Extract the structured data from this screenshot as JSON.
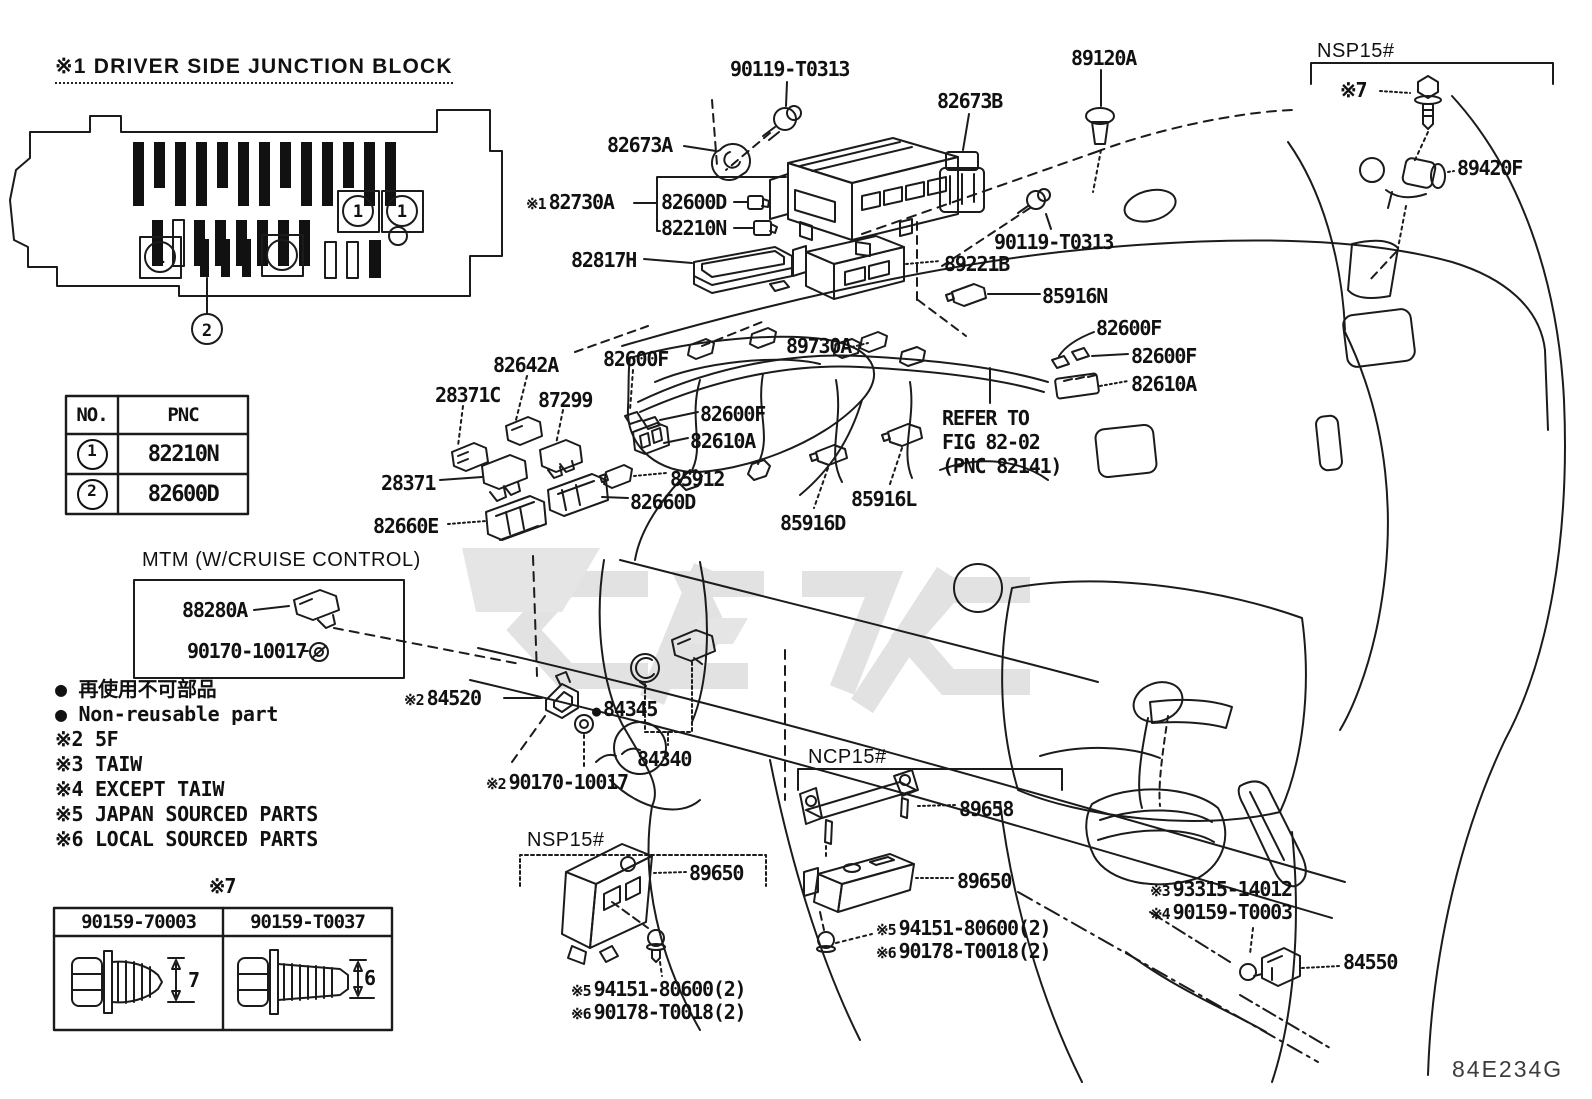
{
  "header": {
    "title": "※1 DRIVER SIDE JUNCTION BLOCK"
  },
  "figure_code": "84E234G",
  "callouts": {
    "fuse_no": "1",
    "junction_block_no": "2"
  },
  "pnc_table": {
    "col_no": "NO.",
    "col_pnc": "PNC",
    "rows": [
      {
        "no": "1",
        "pnc": "82210N"
      },
      {
        "no": "2",
        "pnc": "82600D"
      }
    ]
  },
  "bolt_table": {
    "caption": "※7",
    "columns": [
      {
        "part": "90159-70003",
        "dim": "7"
      },
      {
        "part": "90159-T0037",
        "dim": "6"
      }
    ]
  },
  "legend": {
    "items": [
      "● 再使用不可部品",
      "● Non-reusable part",
      "※2 5F",
      "※3 TAIW",
      "※4 EXCEPT TAIW",
      "※5 JAPAN SOURCED PARTS",
      "※6 LOCAL SOURCED PARTS"
    ]
  },
  "part_labels": [
    {
      "text": "90119-T0313",
      "x": 730,
      "y": 57
    },
    {
      "text": "89120A",
      "x": 1071,
      "y": 46
    },
    {
      "text": "NSP15#",
      "x": 1317,
      "y": 40,
      "style": "plain"
    },
    {
      "text": "※7",
      "x": 1340,
      "y": 78
    },
    {
      "text": "82673B",
      "x": 937,
      "y": 89
    },
    {
      "text": "82673A",
      "x": 607,
      "y": 133
    },
    {
      "text": "89420F",
      "x": 1457,
      "y": 156
    },
    {
      "prefix": "※1",
      "text": "82730A",
      "x": 526,
      "y": 190
    },
    {
      "text": "82600D",
      "x": 661,
      "y": 190
    },
    {
      "text": "82210N",
      "x": 661,
      "y": 216
    },
    {
      "text": "90119-T0313",
      "x": 994,
      "y": 230
    },
    {
      "text": "82817H",
      "x": 571,
      "y": 248
    },
    {
      "text": "89221B",
      "x": 944,
      "y": 252
    },
    {
      "text": "85916N",
      "x": 1042,
      "y": 284
    },
    {
      "text": "82600F",
      "x": 1096,
      "y": 316
    },
    {
      "text": "89730A",
      "x": 786,
      "y": 334
    },
    {
      "text": "82600F",
      "x": 1131,
      "y": 344
    },
    {
      "text": "82610A",
      "x": 1131,
      "y": 372
    },
    {
      "text": "82642A",
      "x": 493,
      "y": 353
    },
    {
      "text": "82600F",
      "x": 603,
      "y": 347
    },
    {
      "text": "28371C",
      "x": 435,
      "y": 383
    },
    {
      "text": "87299",
      "x": 538,
      "y": 388
    },
    {
      "text": "82600F",
      "x": 700,
      "y": 402
    },
    {
      "text": "82610A",
      "x": 690,
      "y": 429
    },
    {
      "text": "REFER TO\nFIG 82-02\n(PNC 82141)",
      "x": 942,
      "y": 406
    },
    {
      "text": "28371",
      "x": 381,
      "y": 471
    },
    {
      "text": "85912",
      "x": 670,
      "y": 467
    },
    {
      "text": "82660D",
      "x": 630,
      "y": 490
    },
    {
      "text": "85916L",
      "x": 851,
      "y": 487
    },
    {
      "text": "82660E",
      "x": 373,
      "y": 514
    },
    {
      "text": "85916D",
      "x": 780,
      "y": 511
    },
    {
      "text": "MTM (W/CRUISE CONTROL)",
      "x": 142,
      "y": 549,
      "style": "plain"
    },
    {
      "text": "88280A",
      "x": 182,
      "y": 598
    },
    {
      "text": "90170-10017",
      "x": 187,
      "y": 639
    },
    {
      "prefix": "※2",
      "text": "84520",
      "x": 404,
      "y": 686
    },
    {
      "prefix": "●",
      "text": "84345",
      "x": 592,
      "y": 697
    },
    {
      "text": "84340",
      "x": 637,
      "y": 747
    },
    {
      "prefix": "※2",
      "text": "90170-10017",
      "x": 486,
      "y": 770
    },
    {
      "text": "NCP15#",
      "x": 808,
      "y": 746,
      "style": "plain"
    },
    {
      "text": "89658",
      "x": 959,
      "y": 797
    },
    {
      "text": "89650",
      "x": 957,
      "y": 869
    },
    {
      "prefix": "※5",
      "text": "94151-80600(2)",
      "x": 876,
      "y": 916
    },
    {
      "prefix": "※6",
      "text": "90178-T0018(2)",
      "x": 876,
      "y": 939
    },
    {
      "text": "NSP15#",
      "x": 527,
      "y": 829,
      "style": "plain"
    },
    {
      "text": "89650",
      "x": 689,
      "y": 861
    },
    {
      "prefix": "※5",
      "text": "94151-80600(2)",
      "x": 571,
      "y": 977
    },
    {
      "prefix": "※6",
      "text": "90178-T0018(2)",
      "x": 571,
      "y": 1000
    },
    {
      "prefix": "※3",
      "text": "93315-14012",
      "x": 1150,
      "y": 877
    },
    {
      "prefix": "※4",
      "text": "90159-T0003",
      "x": 1150,
      "y": 900
    },
    {
      "text": "84550",
      "x": 1343,
      "y": 950
    },
    {
      "text": "84E234G",
      "x": 1452,
      "y": 1056,
      "style": "plain-lg"
    }
  ]
}
